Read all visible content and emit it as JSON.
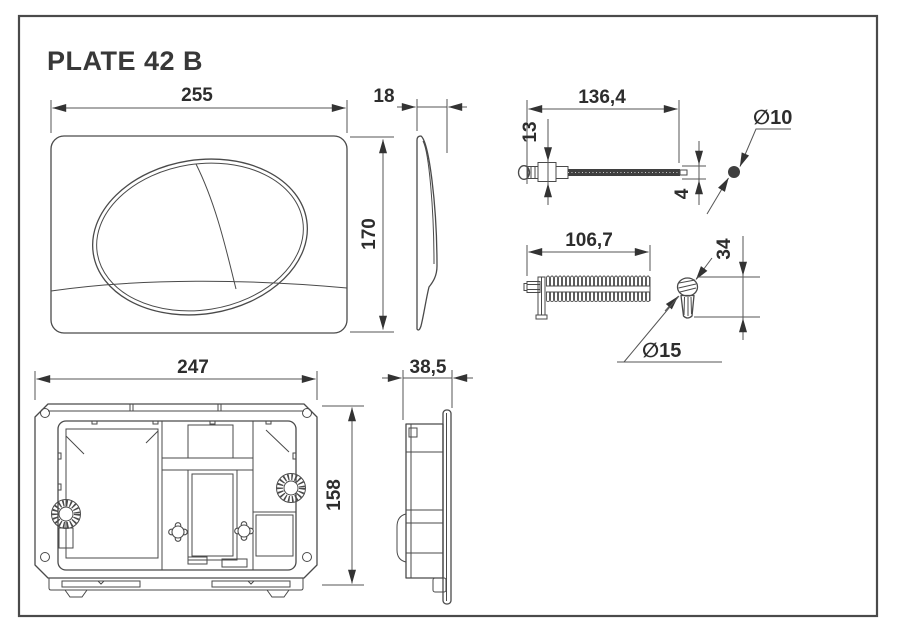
{
  "title": "PLATE 42 B",
  "dimensions": {
    "front_width": "255",
    "front_height": "170",
    "front_depth": "18",
    "pin_length": "136,4",
    "pin_head_height": "13",
    "pin_shaft_thickness": "4",
    "pin_diameter": "∅10",
    "rack_length": "106,7",
    "knob_height": "34",
    "knob_diameter": "∅15",
    "back_width": "247",
    "back_height": "158",
    "back_depth": "38,5"
  }
}
